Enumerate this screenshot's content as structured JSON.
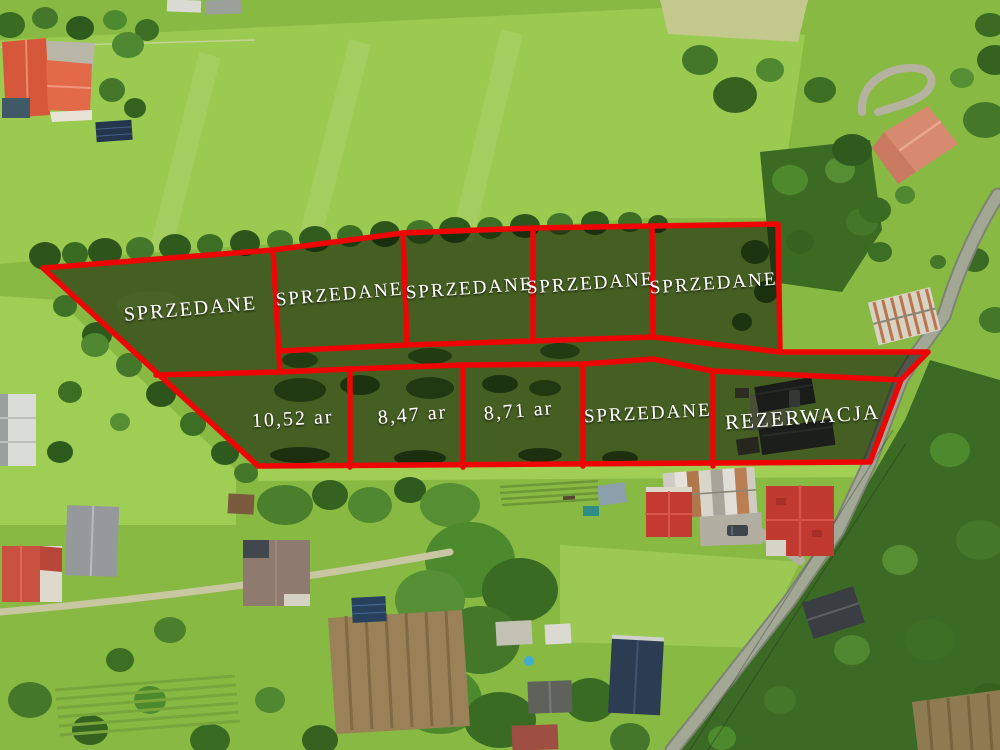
{
  "overlay": {
    "boundary_color": "#ee0606",
    "shade_color": "rgba(8,12,4,0.52)",
    "label_color": "#ffffff",
    "parcels": [
      {
        "name": "parcel-top-1",
        "label": "SPRZEDANE"
      },
      {
        "name": "parcel-top-2",
        "label": "SPRZEDANE"
      },
      {
        "name": "parcel-top-3",
        "label": "SPRZEDANE"
      },
      {
        "name": "parcel-top-4",
        "label": "SPRZEDANE"
      },
      {
        "name": "parcel-top-5",
        "label": "SPRZEDANE"
      },
      {
        "name": "parcel-bottom-1",
        "label": "10,52 ar"
      },
      {
        "name": "parcel-bottom-2",
        "label": "8,47 ar"
      },
      {
        "name": "parcel-bottom-3",
        "label": "8,71 ar"
      },
      {
        "name": "parcel-bottom-4",
        "label": "SPRZEDANE"
      },
      {
        "name": "parcel-bottom-5",
        "label": "REZERWACJA"
      }
    ]
  }
}
